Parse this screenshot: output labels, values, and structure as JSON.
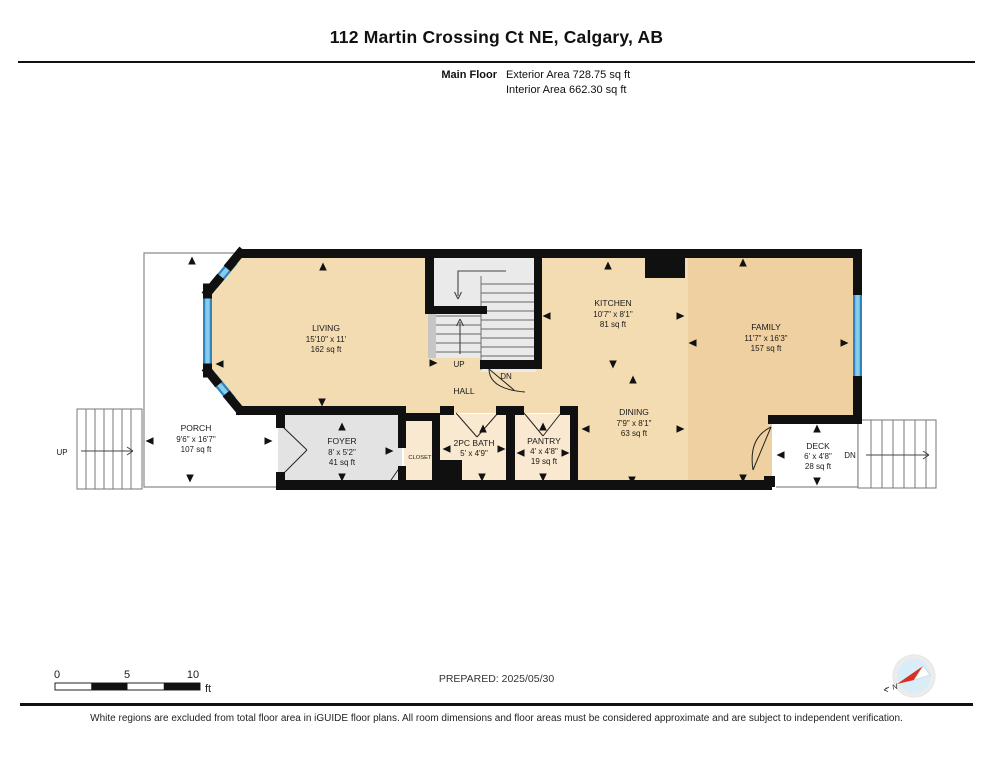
{
  "header": {
    "title": "112 Martin Crossing Ct NE, Calgary, AB",
    "floor_label": "Main Floor",
    "exterior_area": "Exterior Area 728.75 sq ft",
    "interior_area": "Interior Area 662.30 sq ft"
  },
  "rooms": {
    "living": {
      "name": "LIVING",
      "dims": "15'10\" x 11'",
      "area": "162 sq ft"
    },
    "kitchen": {
      "name": "KITCHEN",
      "dims": "10'7\" x 8'1\"",
      "area": "81 sq ft"
    },
    "family": {
      "name": "FAMILY",
      "dims": "11'7\" x 16'3\"",
      "area": "157 sq ft"
    },
    "porch": {
      "name": "PORCH",
      "dims": "9'6\" x 16'7\"",
      "area": "107 sq ft"
    },
    "foyer": {
      "name": "FOYER",
      "dims": "8' x 5'2\"",
      "area": "41 sq ft"
    },
    "bath": {
      "name": "2PC BATH",
      "dims": "5' x 4'9\""
    },
    "pantry": {
      "name": "PANTRY",
      "dims": "4' x 4'8\"",
      "area": "19 sq ft"
    },
    "dining": {
      "name": "DINING",
      "dims": "7'9\" x 8'1\"",
      "area": "63 sq ft"
    },
    "deck": {
      "name": "DECK",
      "dims": "6' x 4'8\"",
      "area": "28 sq ft"
    },
    "hall": {
      "name": "HALL"
    },
    "closet": {
      "name": "CLOSET"
    }
  },
  "stairs": {
    "interior_up": "UP",
    "interior_dn": "DN",
    "porch_up": "UP",
    "deck_dn": "DN"
  },
  "scale_bar": {
    "tick0": "0",
    "tick5": "5",
    "tick10": "10",
    "unit": "ft"
  },
  "compass": {
    "north_label": "N"
  },
  "footer": {
    "prepared": "PREPARED: 2025/05/30",
    "disclaimer": "White regions are excluded from total floor area in iGUIDE floor plans. All room dimensions and floor areas must be considered approximate and are subject to independent verification."
  },
  "colors": {
    "floor_tan": "#F4DCB2",
    "floor_tan_dark": "#EFD0A0",
    "floor_cream": "#F9E9D0",
    "foyer_gray": "#E3E3E3",
    "stairs_gray": "#EAEAEA",
    "wall_black": "#101010",
    "window_blue": "#2F84BE",
    "window_blue_light": "#87CCEC",
    "compass_fill": "#D8EDF8",
    "compass_needle": "#D93025"
  }
}
